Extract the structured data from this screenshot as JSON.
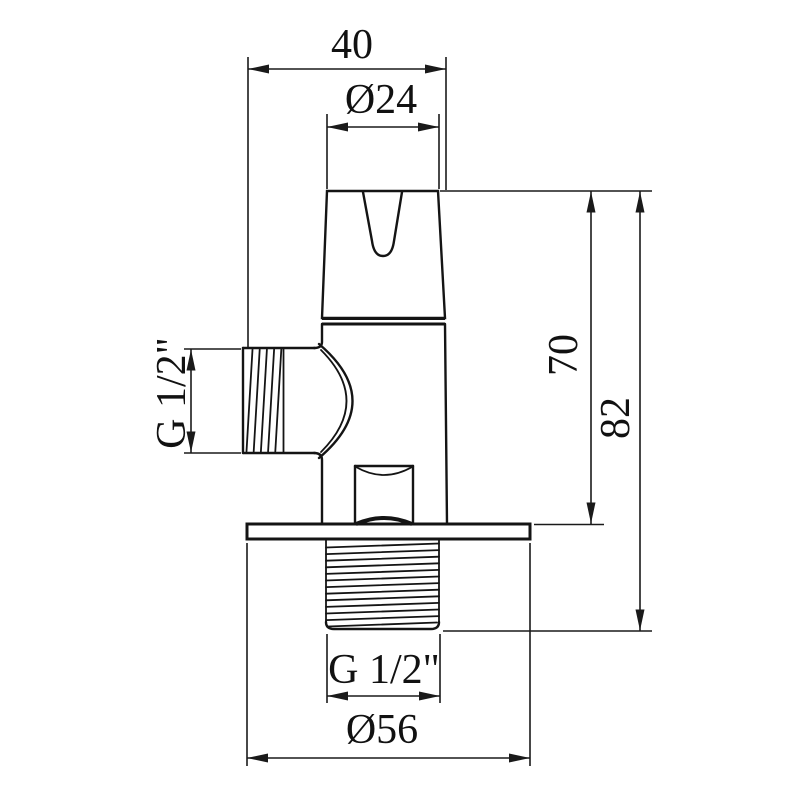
{
  "page": {
    "background": "#ffffff",
    "line_color": "#141414"
  },
  "drawing": {
    "kind": "technical-dimension-drawing",
    "subject": "angle valve, front orthographic view",
    "labels": {
      "top_width": "40",
      "handle_diameter": "Ø24",
      "height_body": "70",
      "height_total": "82",
      "side_thread": "G 1/2\"",
      "bottom_thread": "G 1/2\"",
      "flange_diameter": "Ø56"
    }
  }
}
